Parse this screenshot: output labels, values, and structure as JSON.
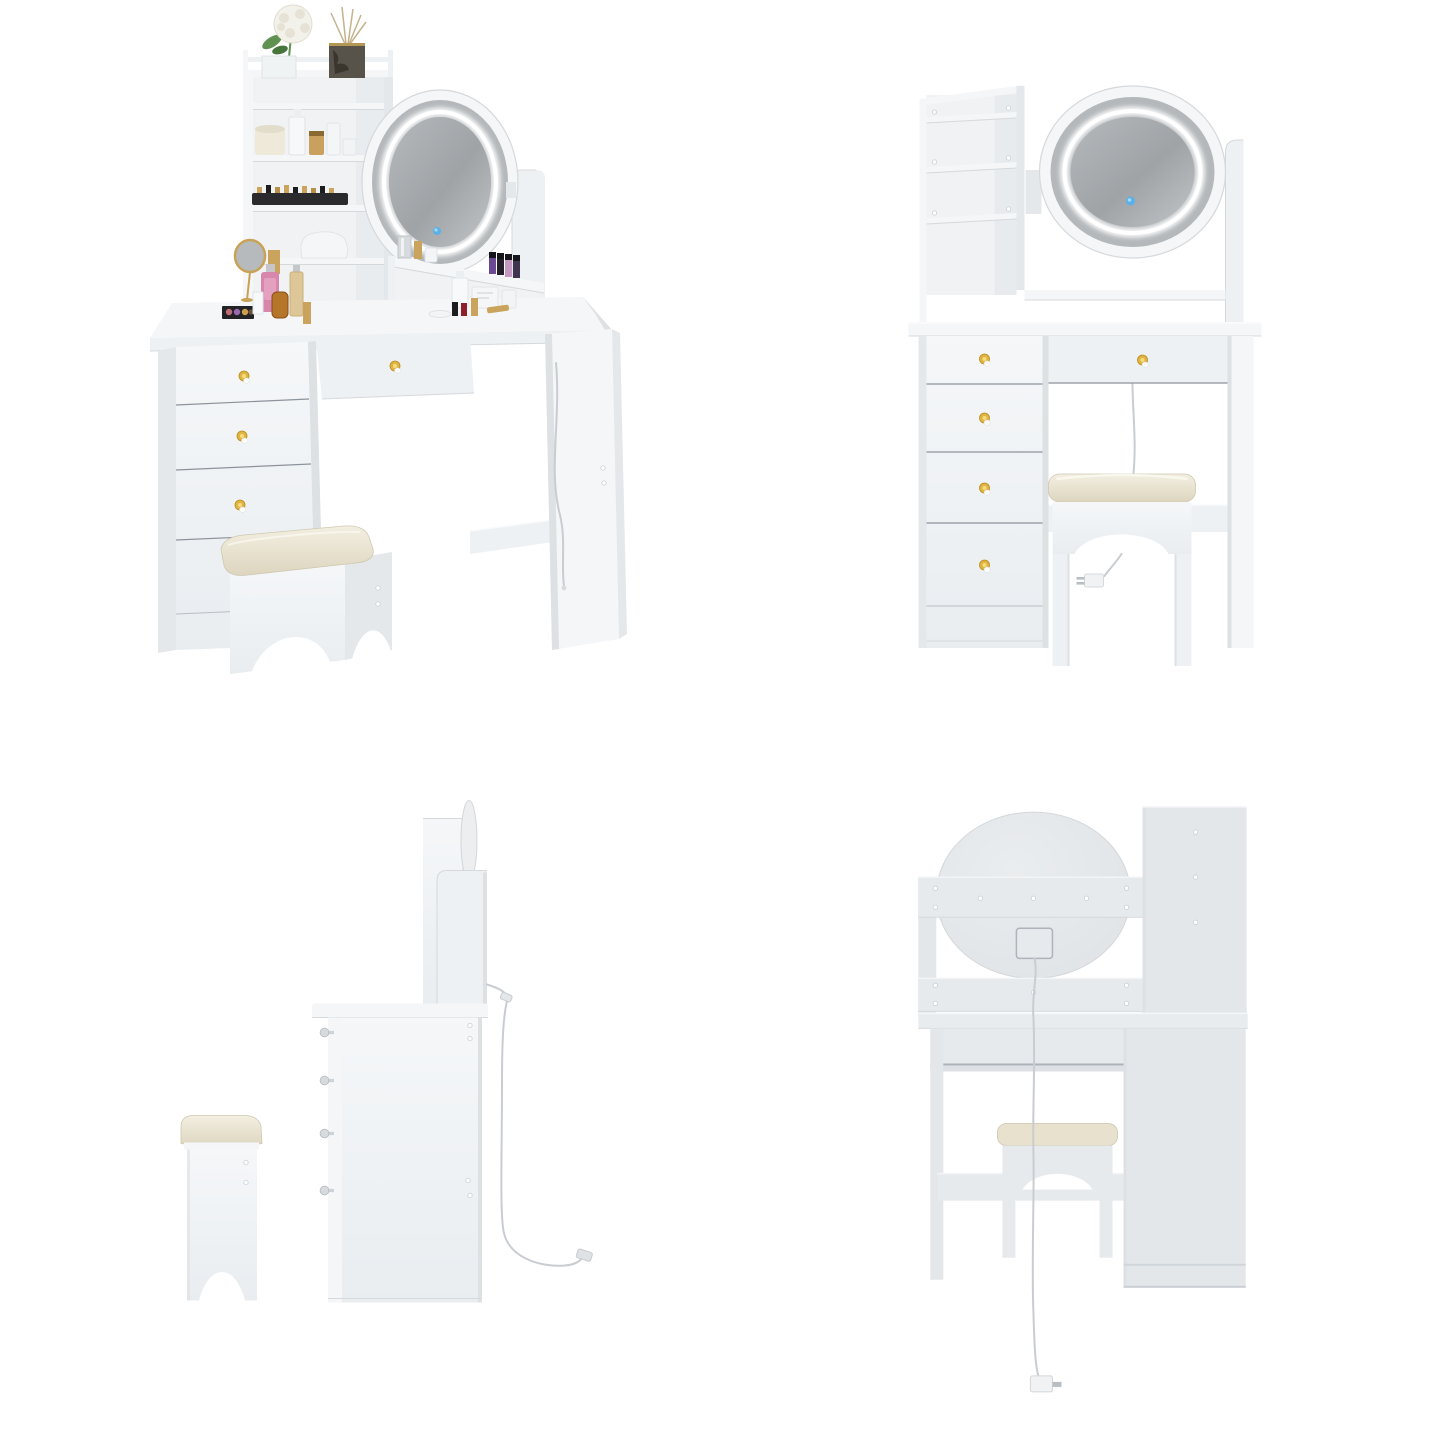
{
  "page": {
    "background": "#ffffff",
    "content": "four product renders of a white LED vanity table set with stool"
  },
  "views": [
    {
      "key": "angled",
      "name": "vanity-angled-view"
    },
    {
      "key": "front",
      "name": "vanity-front-view"
    },
    {
      "key": "side",
      "name": "vanity-side-view"
    },
    {
      "key": "back",
      "name": "vanity-back-view"
    }
  ],
  "colors": {
    "bg": "#ffffff",
    "face": "#f4f6f8",
    "face2": "#eef1f3",
    "side": "#e4e8eb",
    "shade": "#dde1e4",
    "interior": "#f0f2f4",
    "line": "#d5d9dc",
    "dark_line": "#8d939a",
    "back_face": "#e7eaed",
    "back_side": "#e4e7ea",
    "glass_a": "#b6b9bc",
    "glass_b": "#9fa3a6",
    "glass_c": "#c2c5c8",
    "bezel": "#b4b8bb",
    "led": "#ffffff",
    "touch": "#57b1ea",
    "touch_light": "#a8d8f8",
    "gold": "#e0b443",
    "gold_dark": "#b88d1e",
    "gold_light": "#f6dc7a",
    "crystal": "#ffffff",
    "silver": "#d8dbde",
    "cushion_a": "#f3efe1",
    "cushion_b": "#ddd5bf",
    "cushion_edge": "#cfc8b2",
    "amber": "#b5762a",
    "amber_dark": "#8a4f15",
    "pink": "#d787ab",
    "leaf": "#5f9150",
    "leaf_dark": "#47763c",
    "bloom": "#f2f1ea",
    "bloom_shade": "#e6e3d6",
    "diffuser": "#57524a",
    "diffuser_dark": "#3a362e",
    "stick": "#c4b28c",
    "tray": "#2b2b2e",
    "lip_gold": "#caa45c",
    "lip_black": "#1d1d20",
    "candle": "#efe9da",
    "candle_lid": "#e2dcca",
    "purple": "#6b4a92",
    "plum": "#3f3350",
    "lilac": "#c49ac2",
    "black": "#241f2b",
    "red": "#8f1f2a",
    "cable": "#c9cdd1",
    "plug": "#f0f2f4",
    "pin": "#b9bec3",
    "screw": "#fdfefe",
    "screw_ring": "#c3c9ce"
  }
}
